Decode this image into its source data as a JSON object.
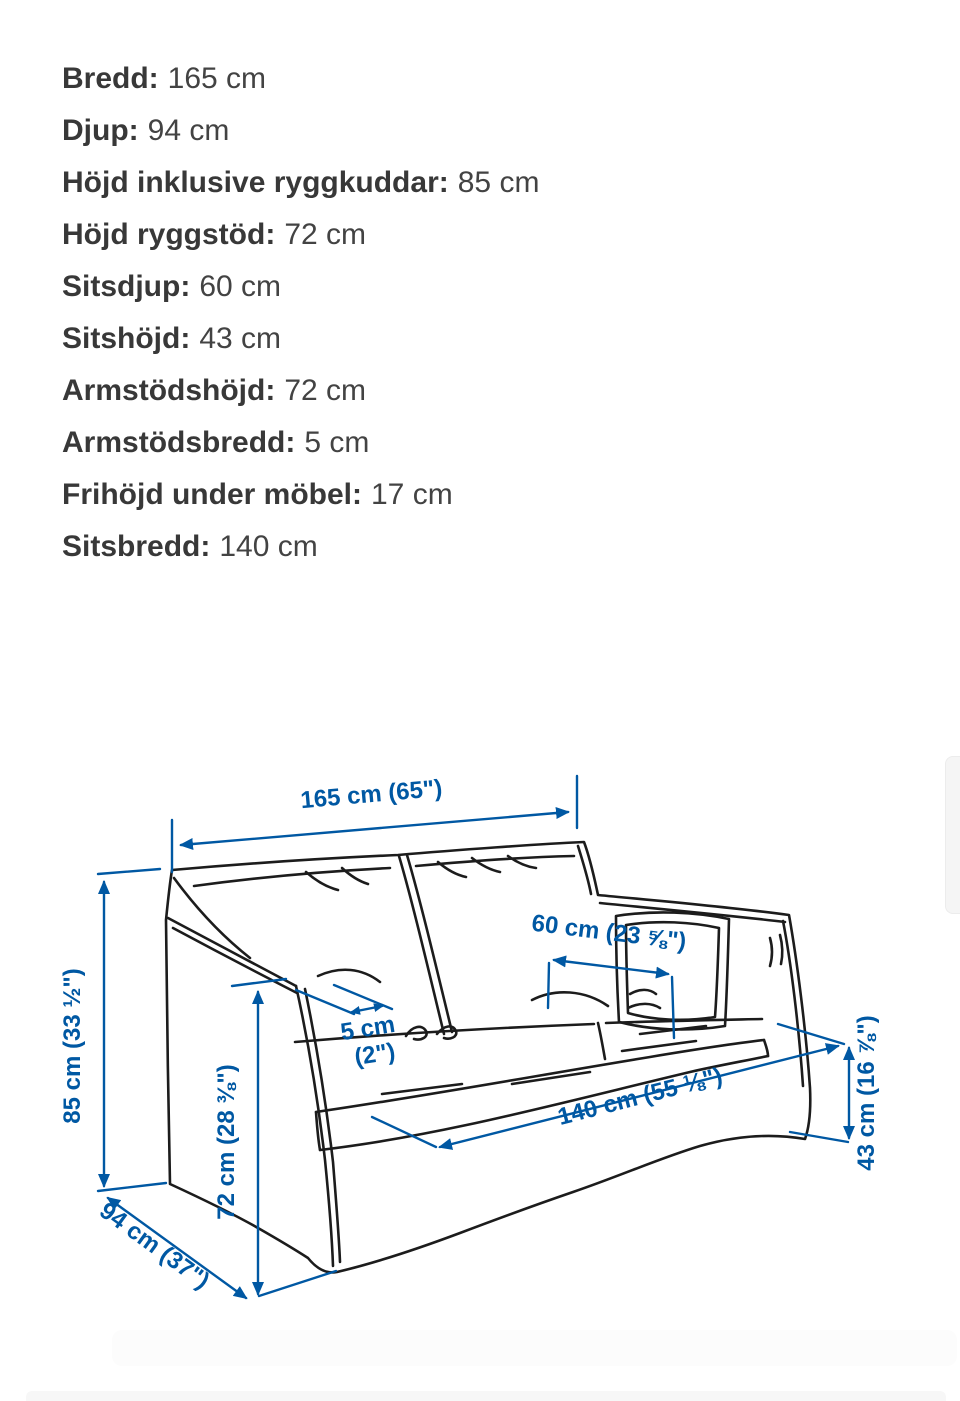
{
  "colors": {
    "dimension_blue": "#0058a3",
    "sketch_black": "#1c1c1c",
    "text_dark": "#3d3d3d",
    "background": "#ffffff"
  },
  "specs": {
    "items": [
      {
        "label": "Bredd:",
        "value": "165 cm"
      },
      {
        "label": "Djup:",
        "value": "94 cm"
      },
      {
        "label": "Höjd inklusive ryggkuddar:",
        "value": "85 cm"
      },
      {
        "label": "Höjd ryggstöd:",
        "value": "72 cm"
      },
      {
        "label": "Sitsdjup:",
        "value": "60 cm"
      },
      {
        "label": "Sitshöjd:",
        "value": "43 cm"
      },
      {
        "label": "Armstödshöjd:",
        "value": "72 cm"
      },
      {
        "label": "Armstödsbredd:",
        "value": "5 cm"
      },
      {
        "label": "Frihöjd under möbel:",
        "value": "17 cm"
      },
      {
        "label": "Sitsbredd:",
        "value": "140 cm"
      }
    ]
  },
  "diagram": {
    "labels": {
      "width_165": "165 cm (65\")",
      "height_85": "85 cm (33 ½\")",
      "depth_94": "94 cm (37\")",
      "back_height_72": "72 cm (28 ⅜\")",
      "arm_width_5_line1": "5 cm",
      "arm_width_5_line2": "(2\")",
      "seat_depth_60": "60 cm (23 ⅝\")",
      "seat_width_140": "140 cm (55 ⅛\")",
      "seat_height_43": "43 cm (16 ⅞\")"
    }
  }
}
